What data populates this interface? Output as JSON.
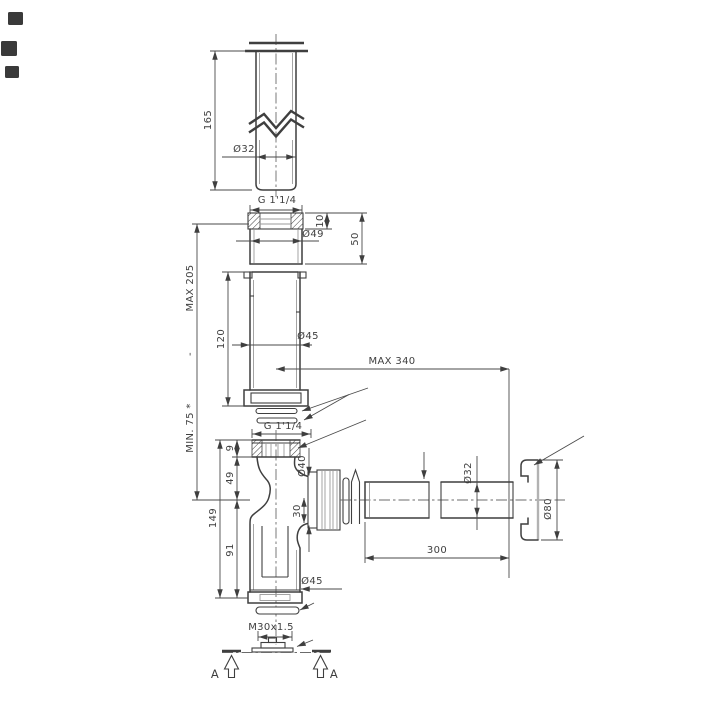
{
  "colors": {
    "line": "#3f3f3f",
    "light_line": "#9a9a9a",
    "background": "#ffffff"
  },
  "labels": {
    "tail_length": "165",
    "tail_diameter": "Ø32",
    "thread_top": "G 1'1/4",
    "bush_lip": "10",
    "bush_diameter": "Ø49",
    "bush_height": "50",
    "height_max": "MAX 205",
    "height_sep": "-",
    "height_min": "MIN. 75 *",
    "ext_length": "120",
    "ext_diameter": "Ø45",
    "reach_max": "MAX 340",
    "thread_body": "G 1'1/4",
    "lip_height": "9",
    "upper_height": "49",
    "total_height": "149",
    "lower_height": "91",
    "outlet_diameter": "Ø40",
    "outlet_offset": "30",
    "wallpipe_diameter": "Ø32",
    "wallpipe_length": "300",
    "rosette_diameter": "Ø80",
    "cup_diameter": "Ø45",
    "plug_thread": "M30x1.5",
    "section_a_left": "A",
    "section_a_right": "A"
  }
}
